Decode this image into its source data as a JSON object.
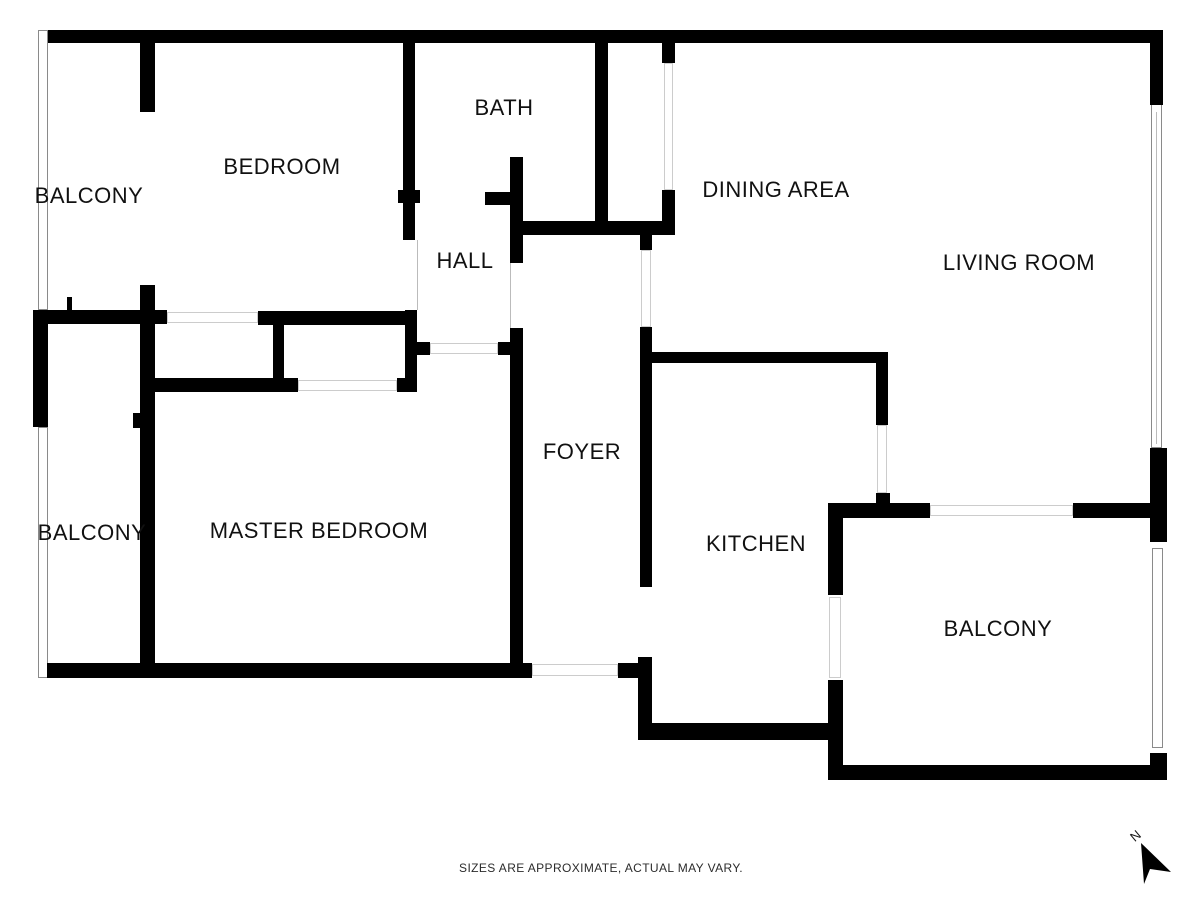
{
  "title": "Apartment floor plan",
  "footer": {
    "disclaimer": "SIZES ARE APPROXIMATE, ACTUAL MAY VARY."
  },
  "compass": {
    "label": "N"
  },
  "colors": {
    "wall": "#000000",
    "railing_line": "#8a8a8a",
    "opening_line": "#cccccc",
    "label_text": "#111111",
    "footer_text": "#2b2b2b"
  },
  "rooms": [
    {
      "id": "balcony-top-left",
      "label": "BALCONY",
      "x": 89,
      "y": 196
    },
    {
      "id": "bedroom",
      "label": "BEDROOM",
      "x": 282,
      "y": 167
    },
    {
      "id": "bath",
      "label": "BATH",
      "x": 504,
      "y": 108
    },
    {
      "id": "hall",
      "label": "HALL",
      "x": 465,
      "y": 261
    },
    {
      "id": "dining-area",
      "label": "DINING AREA",
      "x": 776,
      "y": 190
    },
    {
      "id": "living-room",
      "label": "LIVING ROOM",
      "x": 1019,
      "y": 263
    },
    {
      "id": "foyer",
      "label": "FOYER",
      "x": 582,
      "y": 452
    },
    {
      "id": "master-bedroom",
      "label": "MASTER BEDROOM",
      "x": 319,
      "y": 531
    },
    {
      "id": "balcony-left",
      "label": "BALCONY",
      "x": 92,
      "y": 533
    },
    {
      "id": "kitchen",
      "label": "KITCHEN",
      "x": 756,
      "y": 544
    },
    {
      "id": "balcony-bottom-right",
      "label": "BALCONY",
      "x": 998,
      "y": 629
    }
  ],
  "geometry": {
    "walls": [
      [
        48,
        30,
        1115,
        13
      ],
      [
        1150,
        43,
        13,
        62
      ],
      [
        1150,
        448,
        17,
        94
      ],
      [
        1150,
        753,
        17,
        27
      ],
      [
        828,
        765,
        339,
        15
      ],
      [
        828,
        503,
        15,
        92
      ],
      [
        828,
        680,
        15,
        100
      ],
      [
        828,
        503,
        102,
        15
      ],
      [
        1073,
        503,
        94,
        15
      ],
      [
        650,
        723,
        193,
        17
      ],
      [
        638,
        657,
        14,
        83
      ],
      [
        618,
        663,
        22,
        15
      ],
      [
        47,
        663,
        485,
        15
      ],
      [
        510,
        328,
        13,
        339
      ],
      [
        498,
        342,
        13,
        13
      ],
      [
        140,
        42,
        15,
        70
      ],
      [
        140,
        285,
        15,
        382
      ],
      [
        133,
        413,
        9,
        15
      ],
      [
        33,
        310,
        15,
        117
      ],
      [
        33,
        310,
        134,
        14
      ],
      [
        258,
        311,
        159,
        14
      ],
      [
        273,
        324,
        11,
        54
      ],
      [
        155,
        378,
        143,
        14
      ],
      [
        397,
        378,
        20,
        14
      ],
      [
        405,
        310,
        12,
        82
      ],
      [
        417,
        342,
        13,
        13
      ],
      [
        67,
        297,
        5,
        14
      ],
      [
        403,
        42,
        12,
        198
      ],
      [
        398,
        190,
        22,
        13
      ],
      [
        485,
        192,
        25,
        13
      ],
      [
        510,
        157,
        13,
        106
      ],
      [
        520,
        221,
        155,
        14
      ],
      [
        595,
        40,
        13,
        185
      ],
      [
        662,
        40,
        13,
        23
      ],
      [
        662,
        190,
        13,
        45
      ],
      [
        640,
        235,
        12,
        15
      ],
      [
        640,
        327,
        12,
        260
      ],
      [
        652,
        352,
        236,
        11
      ],
      [
        876,
        363,
        12,
        62
      ],
      [
        876,
        493,
        14,
        10
      ]
    ],
    "railings": [
      [
        38,
        30,
        10,
        280
      ],
      [
        38,
        427,
        10,
        251
      ],
      [
        1151,
        103,
        11,
        345
      ],
      [
        1152,
        548,
        11,
        200
      ]
    ],
    "openings": [
      [
        167,
        312,
        91,
        11
      ],
      [
        298,
        380,
        99,
        11
      ],
      [
        430,
        343,
        68,
        11
      ],
      [
        532,
        664,
        86,
        12
      ],
      [
        930,
        505,
        143,
        11
      ],
      [
        641,
        250,
        10,
        77
      ],
      [
        877,
        425,
        10,
        68
      ],
      [
        664,
        63,
        9,
        127
      ],
      [
        829,
        597,
        12,
        81
      ]
    ],
    "lines": [
      [
        417,
        240,
        1,
        70
      ],
      [
        510,
        263,
        1,
        65
      ],
      [
        1156,
        112,
        1,
        332
      ]
    ]
  }
}
